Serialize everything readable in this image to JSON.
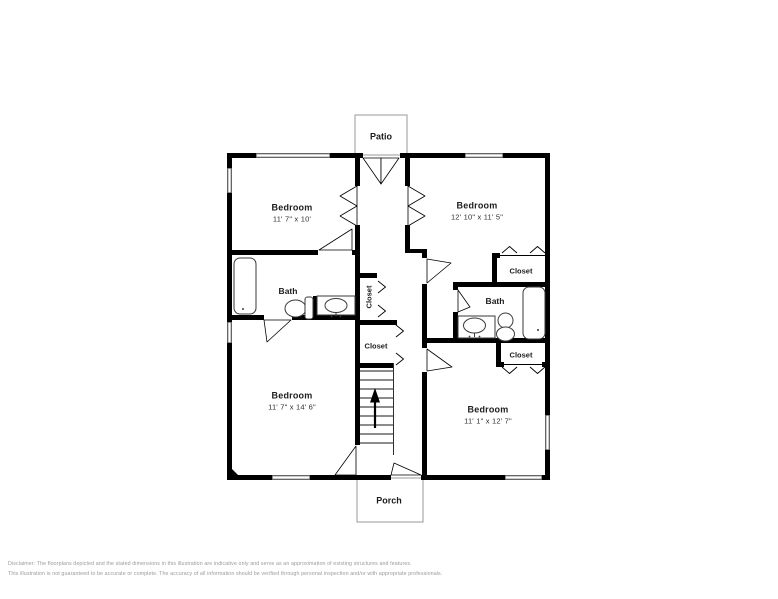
{
  "rooms": {
    "patio": {
      "label": "Patio"
    },
    "porch": {
      "label": "Porch"
    },
    "bedroom_top_left": {
      "label": "Bedroom",
      "dimensions": "11' 7\" x 10'"
    },
    "bedroom_top_right": {
      "label": "Bedroom",
      "dimensions": "12' 10\" x 11' 5\""
    },
    "bedroom_bottom_left": {
      "label": "Bedroom",
      "dimensions": "11' 7\" x 14' 6\""
    },
    "bedroom_bottom_right": {
      "label": "Bedroom",
      "dimensions": "11' 1\" x 12' 7\""
    },
    "bath_left": {
      "label": "Bath"
    },
    "bath_right": {
      "label": "Bath"
    },
    "closet_top_right": {
      "label": "Closet"
    },
    "closet_bottom_right": {
      "label": "Closet"
    },
    "closet_hall_upper": {
      "label": "Closet"
    },
    "closet_hall_lower": {
      "label": "Closet"
    }
  },
  "disclaimer": {
    "line1": "Disclaimer: The floorplans depicted and the stated dimensions in this illustration are indicative only and serve as an approximation of existing structures and features.",
    "line2": "This illustration is not guaranteed to be accurate or complete. The accuracy of all information should be verified through personal inspection and/or with appropriate professionals."
  },
  "colors": {
    "wall": "#000000",
    "fixture_outline": "#3a3a3a",
    "stub_outline": "#9a9a9a",
    "label": "#1c1c1c",
    "disclaimer": "#9a9a9a",
    "background": "#ffffff"
  }
}
